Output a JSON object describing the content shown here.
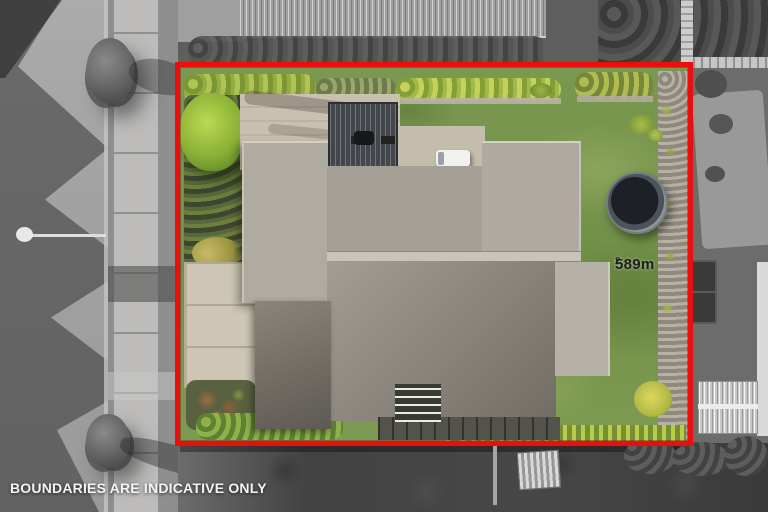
{
  "photo": {
    "type": "aerial-property-photo",
    "area_label": {
      "value": "589m",
      "superscript": "2"
    },
    "disclaimer": "BOUNDARIES ARE INDICATIVE ONLY",
    "colors": {
      "boundary_outline": "#ec0d0d",
      "lawn_green": "#76944e",
      "hedge_green": "#a2b848",
      "roof_gray": "#aaa59b",
      "patio_concrete": "#c9c1b0",
      "surround_grayscale": "#868686",
      "area_label_text": "#1f1f1f",
      "disclaimer_text": "#f4f4f4"
    }
  }
}
